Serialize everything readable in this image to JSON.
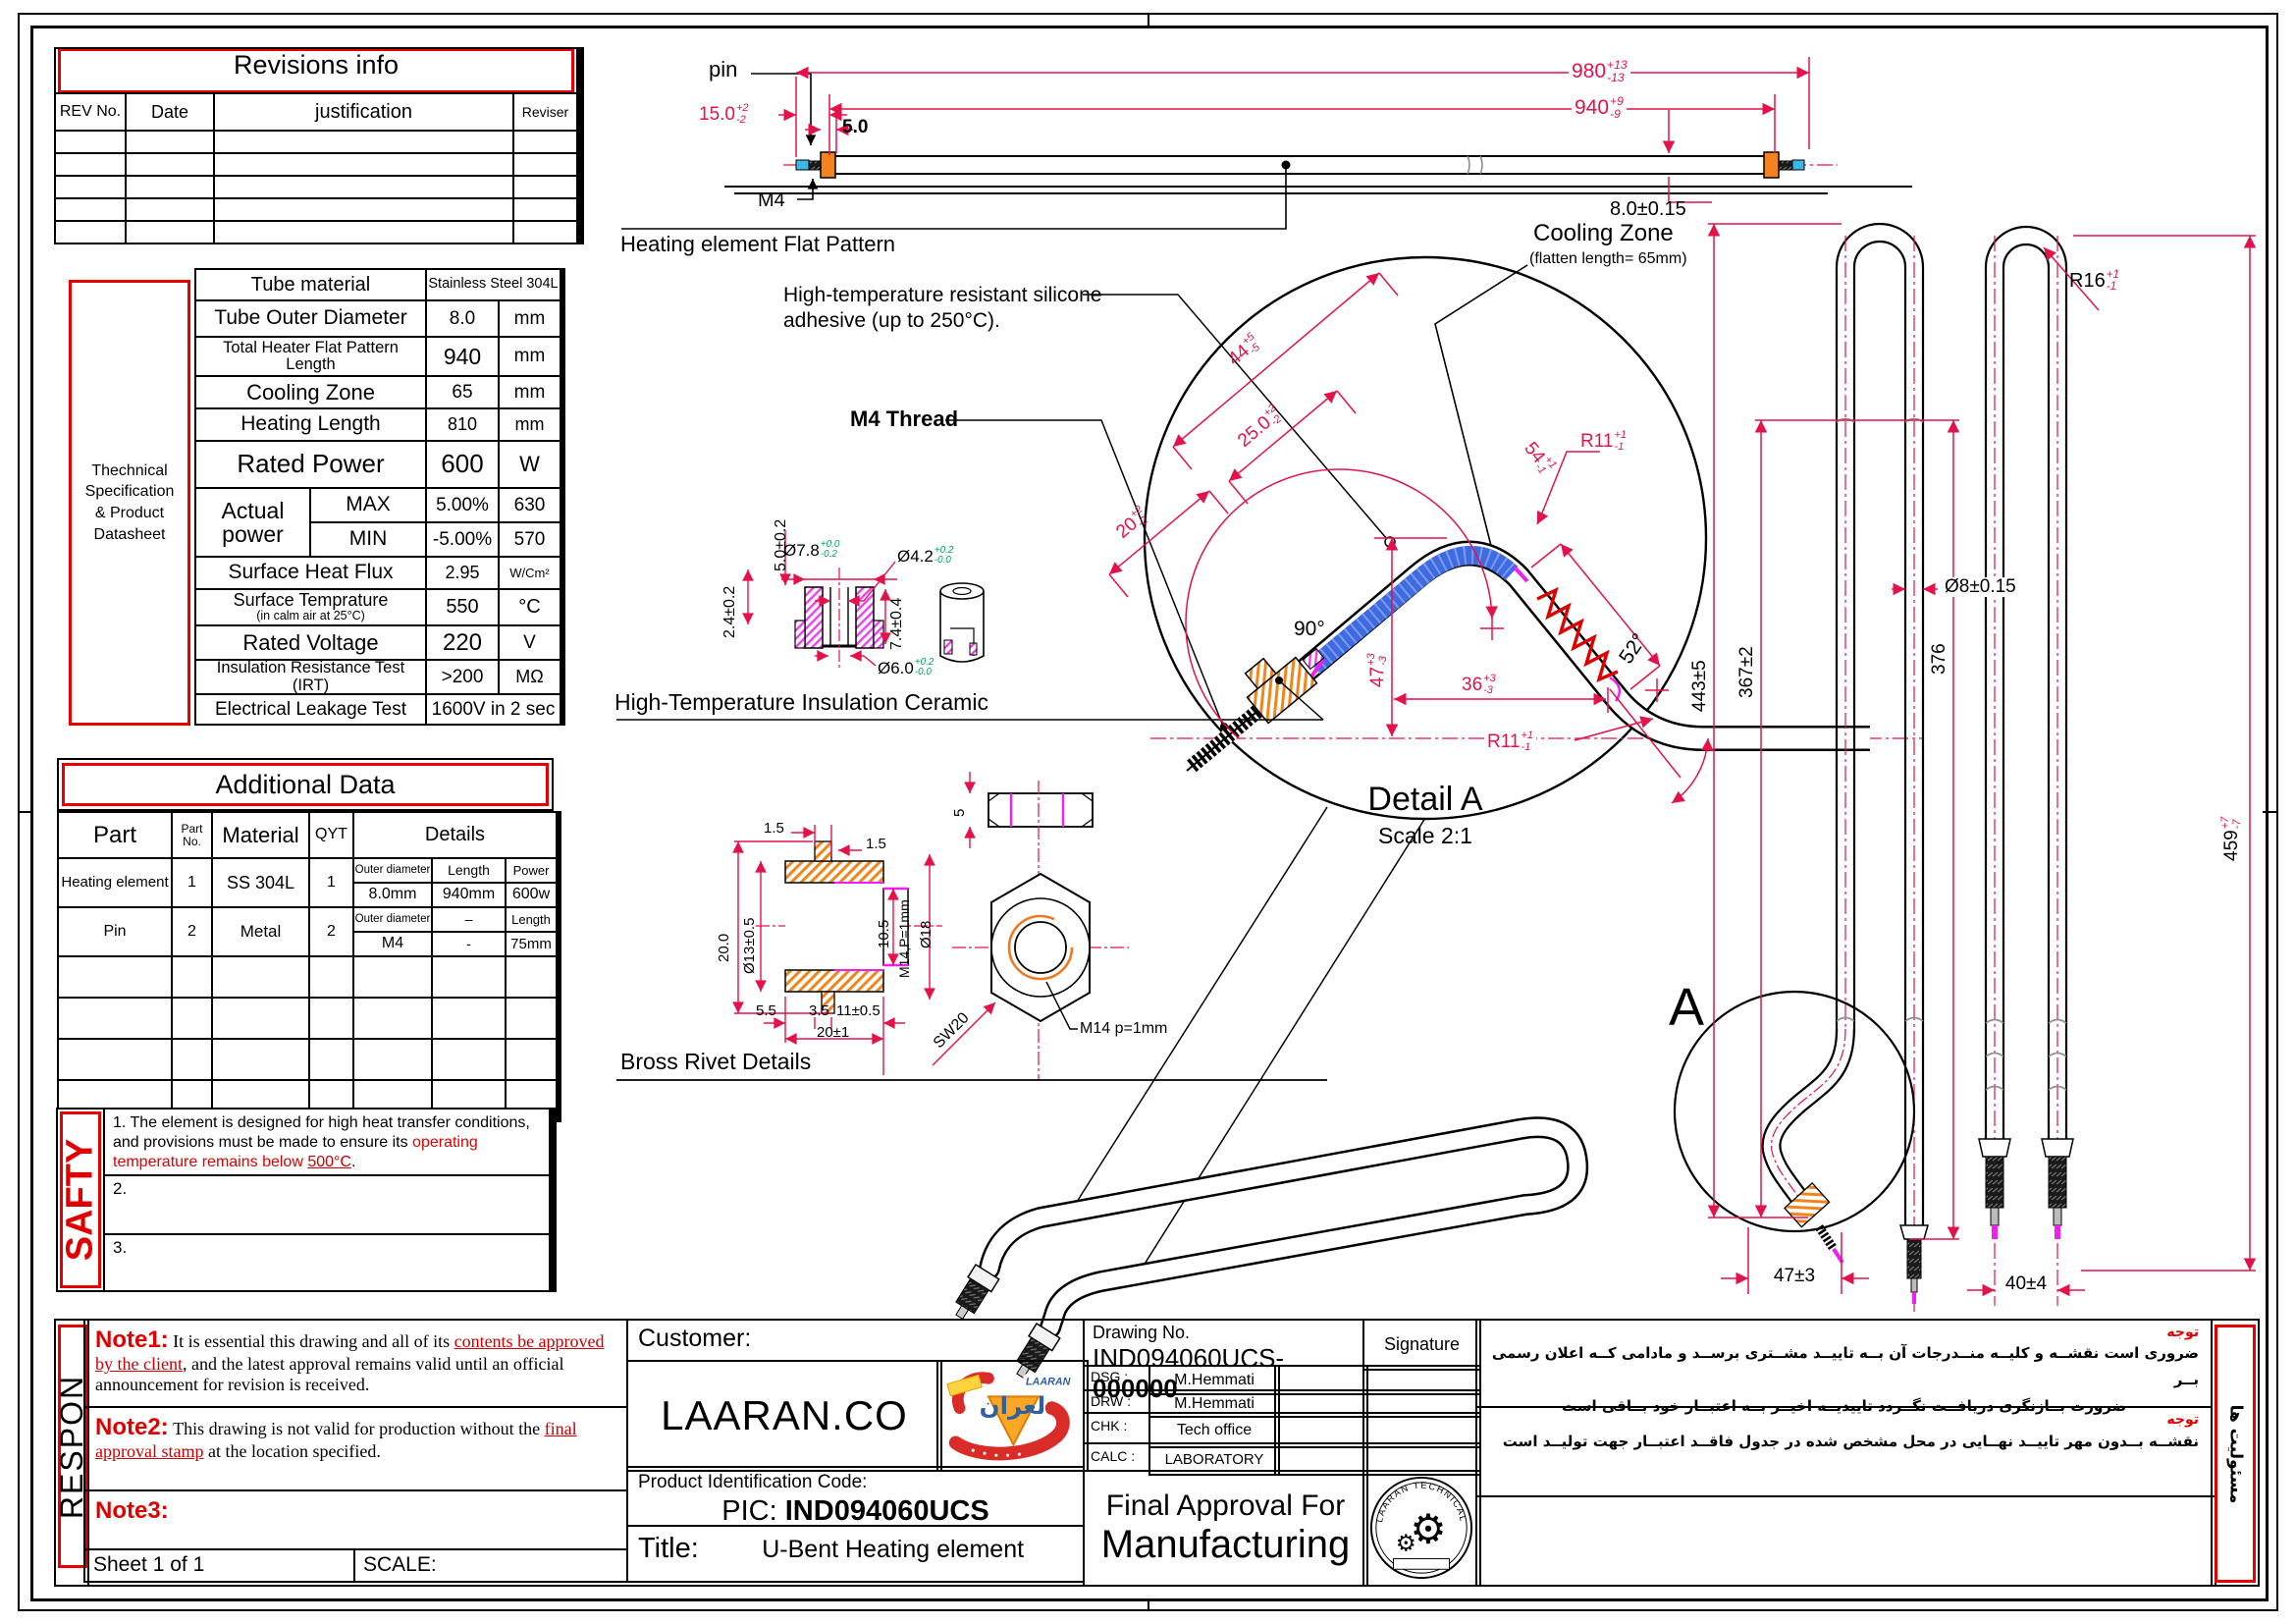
{
  "colors": {
    "dim_red": "#e4124b",
    "table_red": "#e80000",
    "tol_green": "#00a651",
    "ferrule_orange": "#f58220",
    "adhesive_blue": "#3f6be0",
    "magenta": "#f020f0",
    "pin_blue": "#3bb7e8"
  },
  "revisions": {
    "title": "Revisions info",
    "h": [
      "REV No.",
      "Date",
      "justification",
      "Reviser"
    ]
  },
  "spec": {
    "side": [
      "Thechnical",
      "Specification",
      "& Product",
      "Datasheet"
    ],
    "r0l": "Tube material",
    "r0v": "Stainless Steel 304L",
    "r1l": "Tube Outer Diameter",
    "r1v": "8.0",
    "r1u": "mm",
    "r2l": "Total Heater Flat Pattern Length",
    "r2v": "940",
    "r2u": "mm",
    "r3l": "Cooling Zone",
    "r3v": "65",
    "r3u": "mm",
    "r4l": "Heating Length",
    "r4v": "810",
    "r4u": "mm",
    "r5l": "Rated Power",
    "r5v": "600",
    "r5u": "W",
    "apl": "Actual power",
    "maxl": "MAX",
    "maxv": "5.00%",
    "maxu": "630",
    "minl": "MIN",
    "minv": "-5.00%",
    "minu": "570",
    "r6l": "Surface Heat Flux",
    "r6v": "2.95",
    "r6u": "W/Cm²",
    "r7l": "Surface Temprature",
    "r7s": "(in calm air at 25°C)",
    "r7v": "550",
    "r7u": "°C",
    "r8l": "Rated Voltage",
    "r8v": "220",
    "r8u": "V",
    "r9l": "Insulation Resistance Test (IRT)",
    "r9v": ">200",
    "r9u": "MΩ",
    "r10l": "Electrical Leakage Test",
    "r10v": "1600V in 2 sec"
  },
  "additional": {
    "title": "Additional Data",
    "hPart": "Part",
    "hNo": "Part No.",
    "hMat": "Material",
    "hQyt": "QYT",
    "hDet": "Details",
    "r1": {
      "part": "Heating element",
      "no": "1",
      "mat": "SS 304L",
      "qty": "1",
      "d1": "Outer diameter",
      "d2": "Length",
      "d3": "Power",
      "v1": "8.0mm",
      "v2": "940mm",
      "v3": "600w"
    },
    "r2": {
      "part": "Pin",
      "no": "2",
      "mat": "Metal",
      "qty": "2",
      "d1": "Outer diameter",
      "d2": "–",
      "d3": "Length",
      "v1": "M4",
      "v2": "-",
      "v3": "75mm"
    }
  },
  "safety": {
    "side": "SAFTY",
    "s1a": "1. The element is designed for high heat transfer conditions, and provisions must be made to ensure its ",
    "s1b": "operating temperature remains below ",
    "s1c": "500°C",
    "s1d": ".",
    "s2": "2.",
    "s3": "3."
  },
  "tb": {
    "respon": "RESPON",
    "n1l": "Note1:",
    "n1a": "It is essential this drawing and all of its ",
    "n1b": "contents be approved by the client",
    "n1c": ", and the latest approval remains valid until an official announcement for revision is received.",
    "n2l": "Note2:",
    "n2a": "This drawing is not valid for production without the ",
    "n2b": "final approval stamp",
    "n2c": " at the location specified.",
    "n3l": "Note3:",
    "sheet": "Sheet 1 of 1",
    "scale": "SCALE:",
    "customer": "Customer:",
    "company": "LAARAN.CO",
    "picl": "Product Identification Code:",
    "picp": "PIC: ",
    "picv": "IND094060UCS",
    "titlel": "Title:",
    "titlev": "U-Bent Heating element",
    "dnol": "Drawing No.",
    "dnop": "IND094060UCS-",
    "dnob": "000000",
    "sig": "Signature",
    "r1k": "DSG :",
    "r1v": "M.Hemmati",
    "r2k": "DRW :",
    "r2v": "M.Hemmati",
    "r3k": "CHK :",
    "r3v": "Tech office",
    "r4k": "CALC :",
    "r4v": "LABORATORY",
    "fin1": "Final Approval For",
    "fin2": "Manufacturing",
    "stamp": "LAARAN TECHNICAL OFFICE",
    "fa_t1": "توجه",
    "fa_l1": "ضروری است نقشــه و کلیــه منــدرجات آن بــه تاییــد مشــتری برســد و مادامی کــه اعلان رسمی بــر",
    "fa_l2": "ضرورت بــازنگری دریافــت نگــردد تاییدیــه اخیــر بــه اعتبــار خود بــاقی است",
    "fa_t2": "توجه",
    "fa_l3": "نقشــه بــدون مهر تاییــد نهــایی در محل مشخص شده در جدول فاقــد اعتبــار جهت تولیــد است",
    "fa_side": "مسئولیت ها",
    "logo_ar": "لعران",
    "logo_en": "LAARAN"
  },
  "flat": {
    "pin": "pin",
    "cap": "Heating element Flat Pattern",
    "cool1": "Cooling Zone",
    "cool2": "(flatten length= 65mm)",
    "d980": {
      "v": "980",
      "u": "+13",
      "d": "-13"
    },
    "d940": {
      "v": "940",
      "u": "+9",
      "d": "-9"
    },
    "d15": {
      "v": "15.0",
      "u": "+2",
      "d": "-2"
    },
    "d5": "5.0",
    "m4": "M4",
    "d8": "8.0±0.15"
  },
  "det": {
    "sil1": "High-temperature resistant silicone",
    "sil2": "adhesive (up to 250°C).",
    "m4t": "M4 Thread",
    "cer": "High-Temperature Insulation Ceramic",
    "d44": {
      "v": "44",
      "u": "+5",
      "d": "-5"
    },
    "d25": {
      "v": "25.0",
      "u": "+2",
      "d": "-2"
    },
    "d20": {
      "v": "20",
      "u": "+2",
      "d": "-2"
    },
    "d54": {
      "v": "54",
      "u": "+1",
      "d": "-1"
    },
    "d47": {
      "v": "47",
      "u": "+3",
      "d": "-3"
    },
    "d36": {
      "v": "36",
      "u": "+3",
      "d": "-3"
    },
    "r11": {
      "v": "R11",
      "u": "+1",
      "d": "-1"
    },
    "a90": "90°",
    "a52": "52°",
    "title": "Detail A",
    "scale": "Scale 2:1"
  },
  "cer": {
    "d78": {
      "v": "Ø7.8",
      "u": "+0.0",
      "d": "-0.2"
    },
    "d42": {
      "v": "Ø4.2",
      "u": "+0.2",
      "d": "-0.0"
    },
    "d60": {
      "v": "Ø6.0",
      "u": "+0.2",
      "d": "-0.0"
    },
    "d50": "5.0±0.2",
    "d24": "2.4±0.2",
    "d74": "7.4±0.4"
  },
  "riv": {
    "cap": "Bross Rivet Details",
    "a": "1.5",
    "b": "1.5",
    "c": "20.0",
    "d": "Ø13±0.5",
    "e": "10.5",
    "f": "M14,P=1mm",
    "g": "Ø18",
    "h": "5.5",
    "i": "3.5",
    "j": "11±0.5",
    "k": "20±1",
    "l": "5",
    "m": "SW20",
    "n": "M14 p=1mm"
  },
  "views": {
    "a": "A",
    "d443": "443±5",
    "d367": "367±2",
    "d376": "376",
    "d8": "Ø8±0.15",
    "d47": "47±3",
    "d40": "40±4",
    "r16": {
      "v": "R16",
      "u": "+1",
      "d": "-1"
    },
    "d459": {
      "v": "459",
      "u": "+7",
      "d": "-7"
    }
  }
}
